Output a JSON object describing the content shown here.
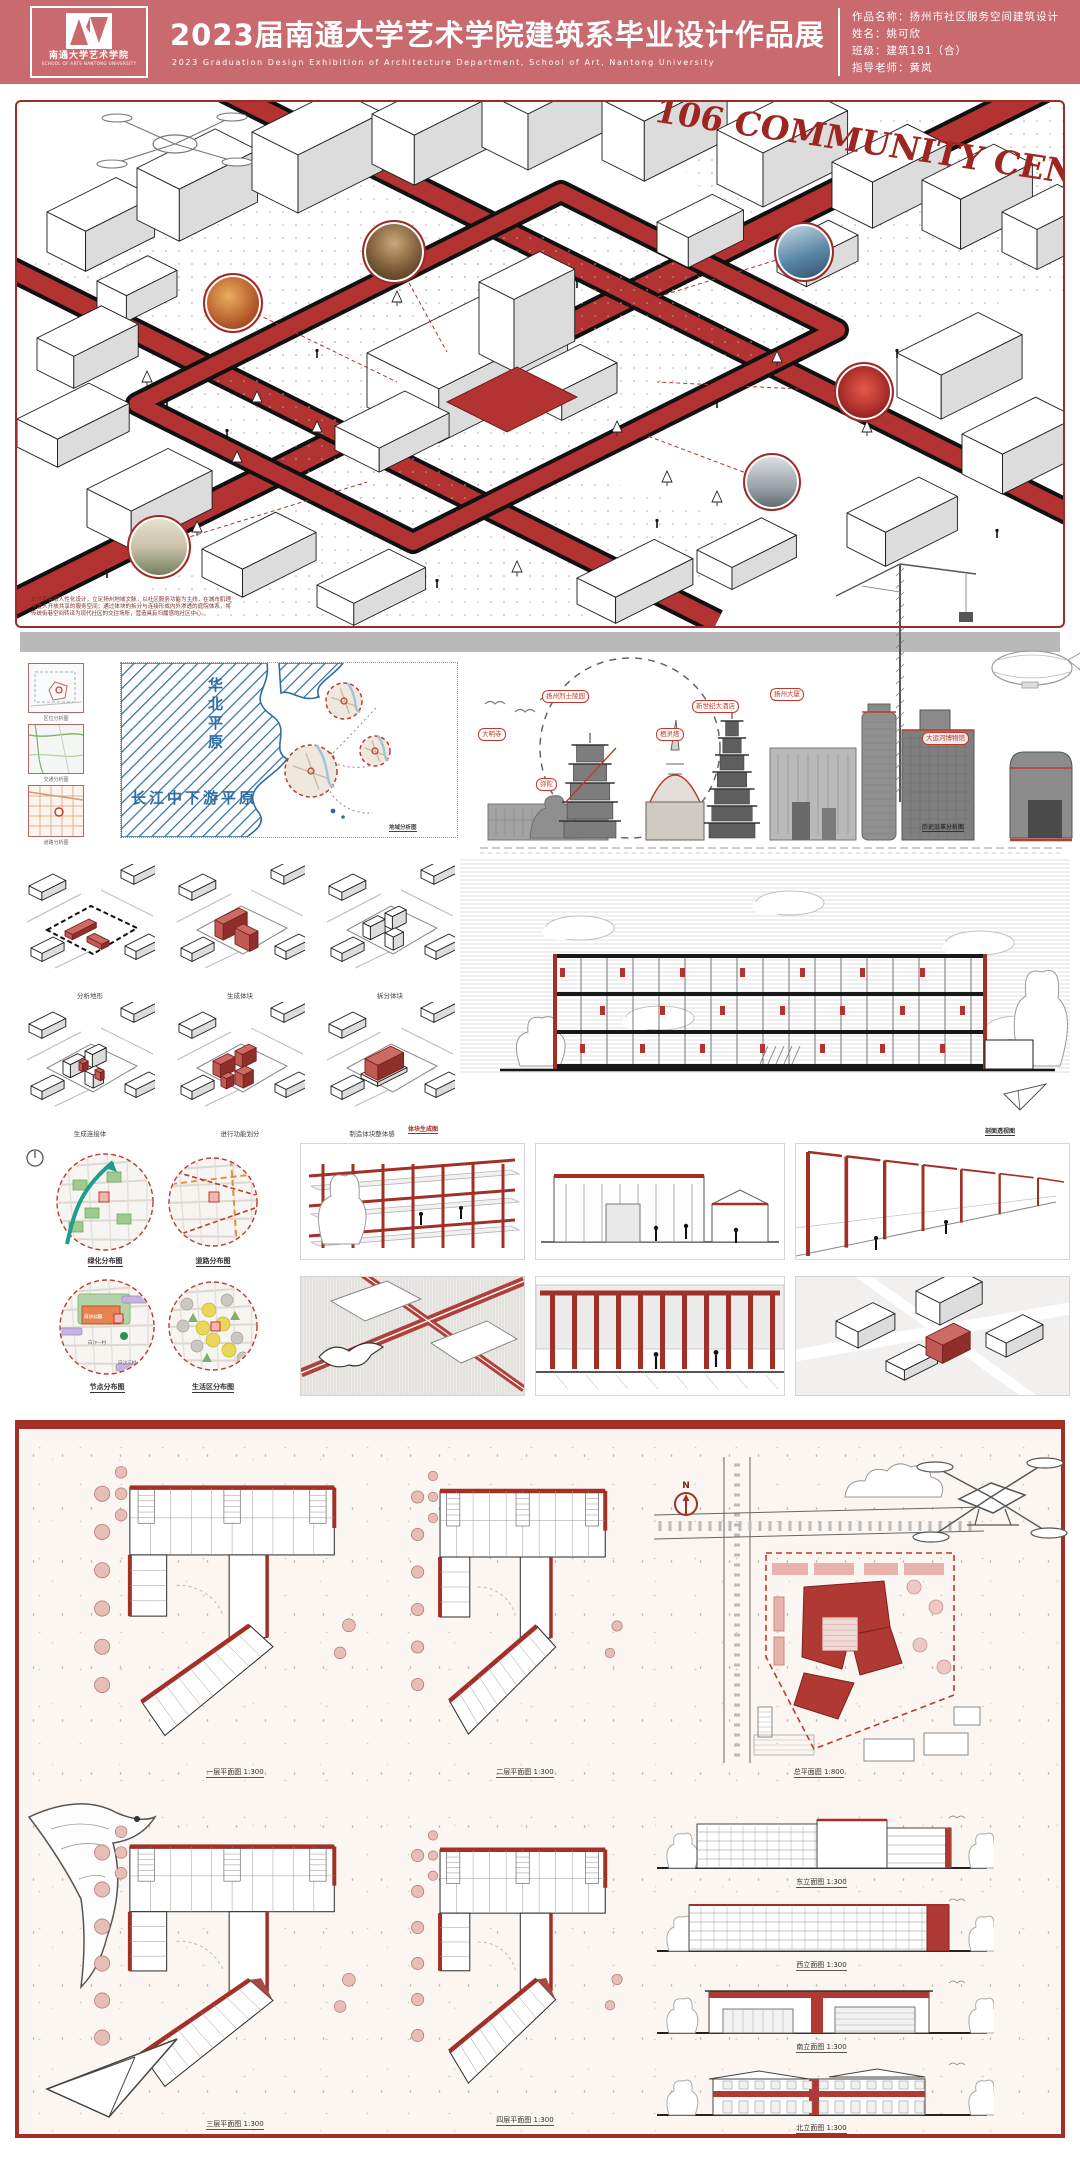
{
  "header": {
    "logo_cn": "南通大学艺术学院",
    "logo_en": "SCHOOL OF ARTS NANTONG UNIVERSITY",
    "title": "2023届南通大学艺术学院建筑系毕业设计作品展",
    "subtitle_en": "2023 Graduation Design Exhibition of Architecture Department, School of Art, Nantong University",
    "info_rows": [
      "作品名称：扬州市社区服务空间建筑设计",
      "姓名：姚可欣",
      "班级：建筑181（合）",
      "指导老师：黄岚"
    ]
  },
  "hero": {
    "title": "106 COMMUNITY CENTER",
    "description": "本方案着眼人性化设计，立足扬州地域文脉，以社区服务功能为主线，在城市肌理中置入开放共享的服务空间；通过体块的拆分与连接形成内外渗透的庭院体系，将传统街巷空间转译为现代社区的交往场所，营造具有归属感的社区中心。"
  },
  "context": {
    "mini_captions": [
      "区位分析图",
      "交通分析图",
      "道路分析图"
    ],
    "map_labels": {
      "north": "华北平原",
      "south": "长江中下游平原"
    },
    "map_caption": "地域分析图",
    "montage_chips": [
      "大明寺",
      "扬州烈士陵园",
      "弥陀",
      "栖灵塔",
      "新世纪大酒店",
      "扬州大厦",
      "大运河博物馆"
    ],
    "montage_caption": "历史沿革分析图"
  },
  "massing": {
    "steps": [
      "分析地形",
      "生成体块",
      "拆分体块",
      "生成连接体",
      "进行功能划分",
      "制造体块整体感"
    ],
    "caption": "体块生成图"
  },
  "section_view": {
    "caption": "剖面透视图"
  },
  "analysis": {
    "labels": [
      "绿化分布图",
      "道路分布图",
      "节点分布图",
      "生活区分布图"
    ],
    "site_labels": [
      "白沙公园",
      "白沙一村",
      "白沙三村"
    ]
  },
  "plans": {
    "floor_captions": [
      "一层平面图 1:300",
      "二层平面图 1:300",
      "三层平面图 1:300",
      "四层平面图 1:300"
    ],
    "site_caption": "总平面图 1:800",
    "elevation_captions": [
      "东立面图 1:300",
      "西立面图 1:300",
      "南立面图 1:300",
      "北立面图 1:300"
    ],
    "north_label": "N"
  },
  "colors": {
    "accent": "#a33026",
    "header": "#c96a6e",
    "road_red": "#b23331",
    "map_blue": "#2e6da4",
    "chip_red": "#c0392b"
  }
}
